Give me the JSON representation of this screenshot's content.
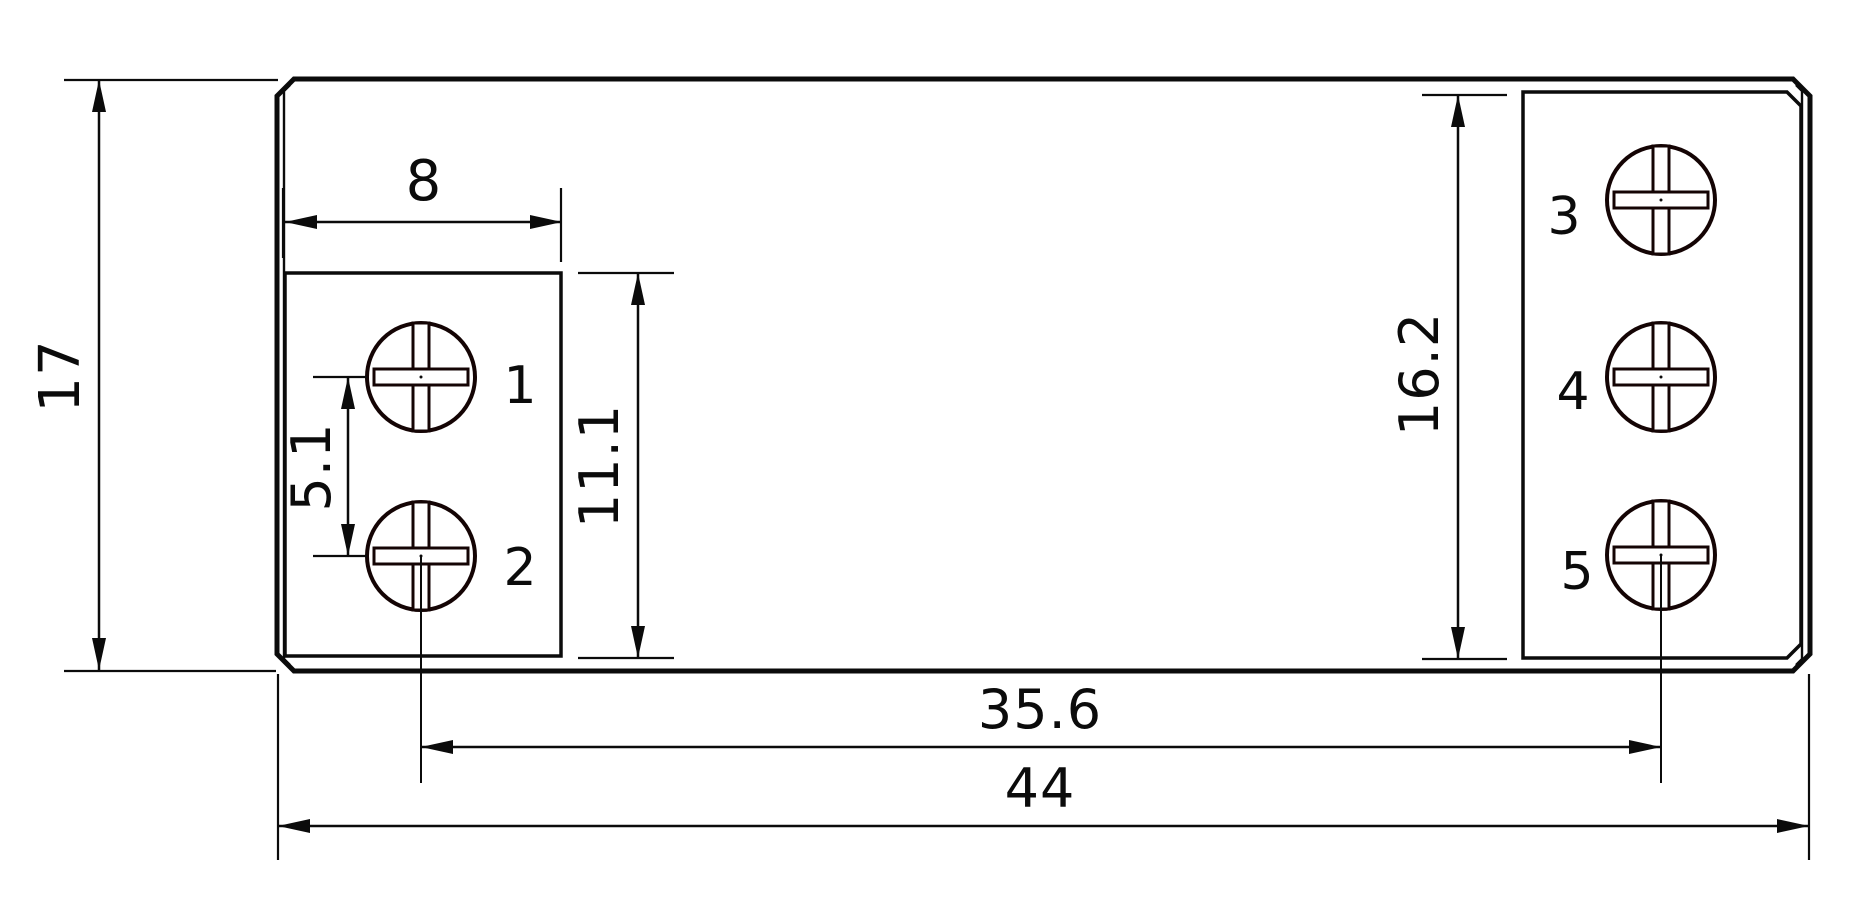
{
  "drawing": {
    "title": "relay-terminal-dimension-drawing",
    "dimensions": {
      "body_height": "17",
      "terminal_hole_width": "8",
      "terminal_pitch": "5.1",
      "left_block_height": "11.1",
      "right_block_height": "16.2",
      "screw_center_span": "35.6",
      "body_width": "44"
    },
    "terminal_labels": [
      "1",
      "2",
      "3",
      "4",
      "5"
    ],
    "colors": {
      "line": "#0b0b0b",
      "terminal_label": "#ed1c24",
      "background": "#ffffff"
    }
  }
}
